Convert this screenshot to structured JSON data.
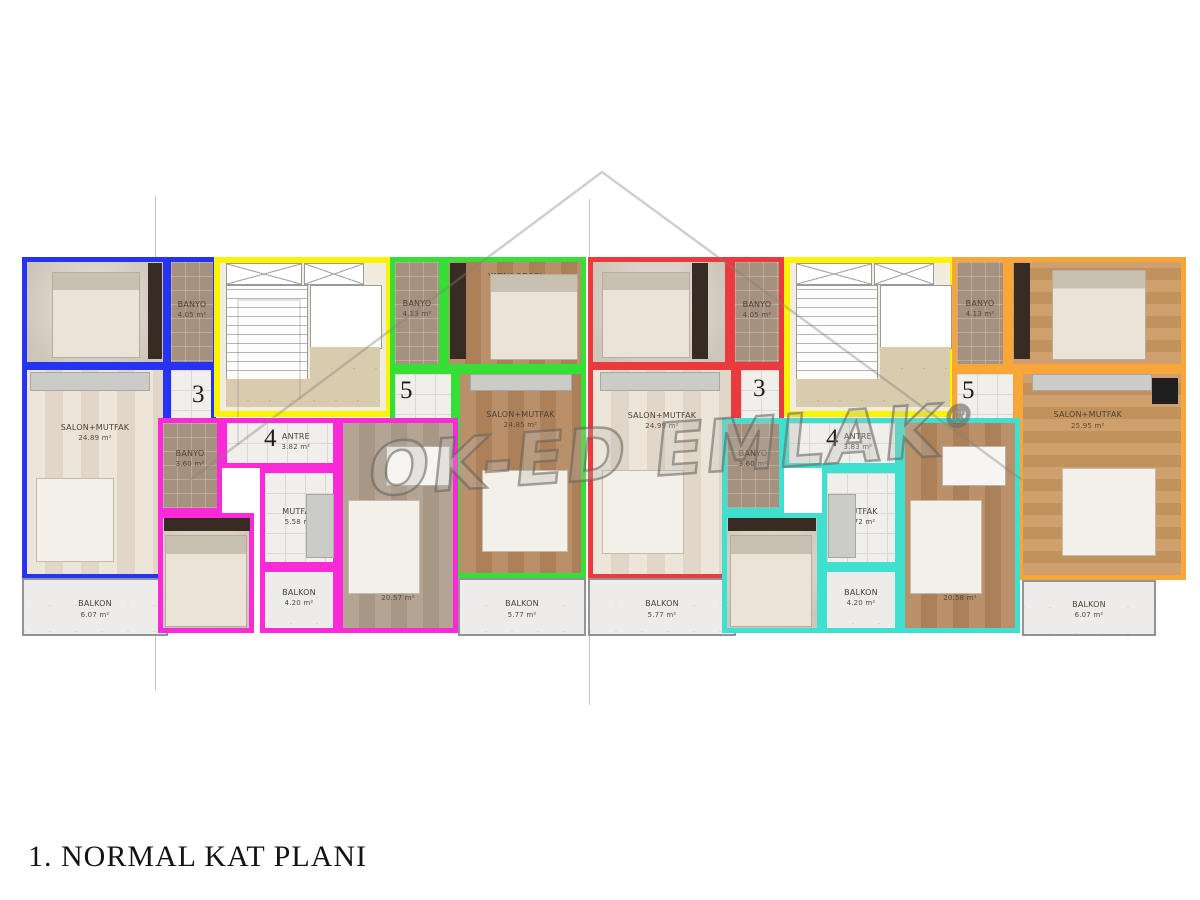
{
  "page": {
    "title": "1. NORMAL KAT PLANI"
  },
  "watermark": {
    "text": "OK-ED EMLAK",
    "registered": "®"
  },
  "colors": {
    "unit3_left": "#2633f0",
    "unit4_left": "#fb2ad8",
    "unit5_left": "#35df35",
    "unit3_right": "#ea3a3e",
    "unit4_right": "#3fe0d0",
    "unit5_right": "#f7a637",
    "stairwell": "#fbf400",
    "wall": "#7a5648"
  },
  "unit_numbers": {
    "u3L": "3",
    "u4L": "4",
    "u5L": "5",
    "u3R": "3",
    "u4R": "4",
    "u5R": "5"
  },
  "rooms": {
    "u3L_bed": {
      "name": "YATAK ODASI",
      "area": "11.74 m²"
    },
    "u3L_banyo": {
      "name": "BANYO",
      "area": "4.05 m²"
    },
    "u3L_salon": {
      "name": "SALON+MUTFAK",
      "area": "24.89 m²"
    },
    "u3L_balkon": {
      "name": "BALKON",
      "area": "6.07 m²"
    },
    "u4L_banyo": {
      "name": "BANYO",
      "area": "3.60 m²"
    },
    "u4L_antre": {
      "name": "ANTRE",
      "area": "3.82 m²"
    },
    "u4L_mutfak": {
      "name": "MUTFAK",
      "area": "5.58 m²"
    },
    "u4L_bed": {
      "name": "YATAK ODASI",
      "area": "11.20 m²"
    },
    "u4L_balkon": {
      "name": "BALKON",
      "area": "4.20 m²"
    },
    "u4L_salon": {
      "name": "SALON",
      "area": "20.57 m²"
    },
    "u5L_banyo": {
      "name": "BANYO",
      "area": "4.13 m²"
    },
    "u5L_bed": {
      "name": "YATAK ODASI",
      "area": "11.74 m²"
    },
    "u5L_salon": {
      "name": "SALON+MUTFAK",
      "area": "24.85 m²"
    },
    "u5L_balkon": {
      "name": "BALKON",
      "area": "5.77 m²"
    },
    "u3R_bed": {
      "name": "YATAK ODASI",
      "area": "11.83 m²"
    },
    "u3R_banyo": {
      "name": "BANYO",
      "area": "4.05 m²"
    },
    "u3R_salon": {
      "name": "SALON+MUTFAK",
      "area": "24.99 m²"
    },
    "u3R_balkon": {
      "name": "BALKON",
      "area": "5.77 m²"
    },
    "u4R_banyo": {
      "name": "BANYO",
      "area": "3.60 m²"
    },
    "u4R_antre": {
      "name": "ANTRE",
      "area": "3.83 m²"
    },
    "u4R_mutfak": {
      "name": "MUTFAK",
      "area": "5.72 m²"
    },
    "u4R_bed": {
      "name": "YATAK ODASI",
      "area": "11.20 m²"
    },
    "u4R_balkon": {
      "name": "BALKON",
      "area": "4.20 m²"
    },
    "u4R_salon": {
      "name": "SALON",
      "area": "20.58 m²"
    },
    "u5R_banyo": {
      "name": "BANYO",
      "area": "4.13 m²"
    },
    "u5R_bed": {
      "name": "YATAK ODASI",
      "area": "14.17 m²"
    },
    "u5R_salon": {
      "name": "SALON+MUTFAK",
      "area": "25.95 m²"
    },
    "u5R_balkon": {
      "name": "BALKON",
      "area": "6.07 m²"
    }
  }
}
